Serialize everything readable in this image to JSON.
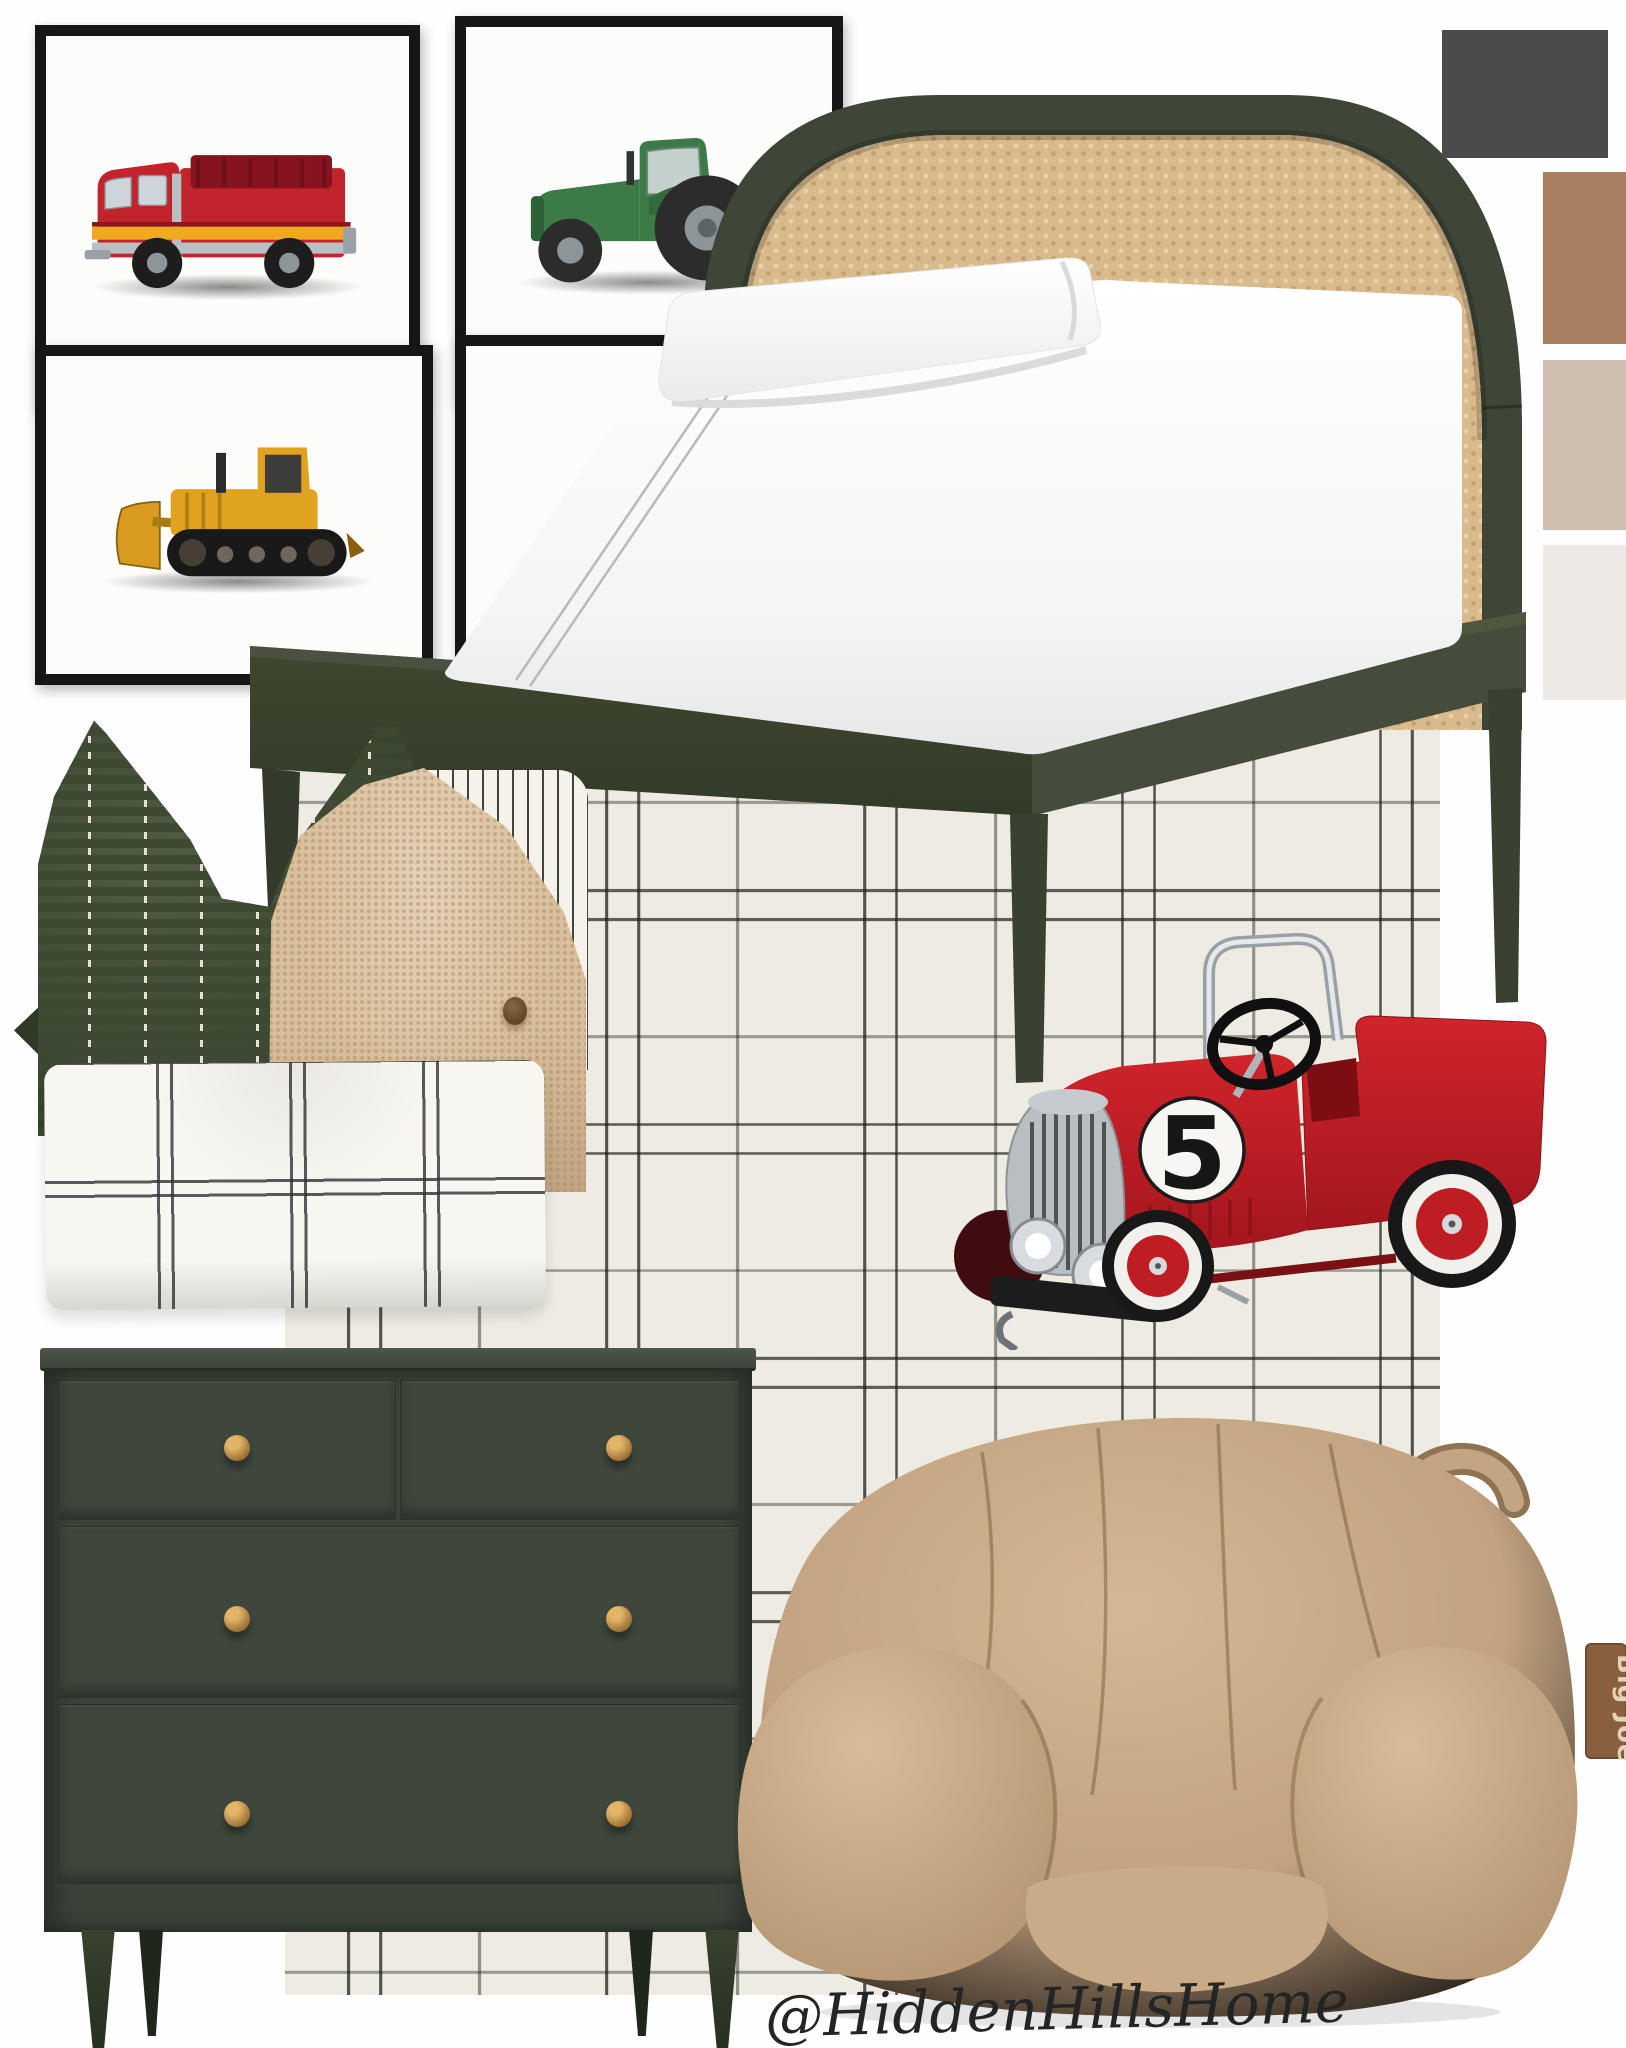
{
  "board": {
    "watermark": "@HiddenHillsHome",
    "background_hex": "#FEFEFE"
  },
  "palette": [
    {
      "name": "charcoal",
      "hex": "#4B4B4D",
      "css": "background:#4B4B4D"
    },
    {
      "name": "saddle-brown",
      "hex": "#A67F5E",
      "css": "background:#A67F5E"
    },
    {
      "name": "warm-beige",
      "hex": "#CEBFB0",
      "css": "background:#CEBFB0"
    },
    {
      "name": "off-white",
      "hex": "#EDEAE5",
      "css": "background:#EDEAE5"
    }
  ],
  "gallery": {
    "prints": [
      {
        "subject": "fire-truck-watercolor"
      },
      {
        "subject": "green-tractor-watercolor"
      },
      {
        "subject": "yellow-bulldozer-watercolor"
      },
      {
        "subject": "blank-mat"
      }
    ]
  },
  "wallpaper": {
    "pattern": "hand-drawn windowpane plaid",
    "base_hex": "#EDEBE2",
    "line_hex": "#1E1E1A"
  },
  "bed": {
    "frame_hex": "#3F4637",
    "cane_hex": "#D9BA8C",
    "headboard": "arched cane"
  },
  "pedal_car": {
    "racing_number": "5",
    "body_hex": "#BF1D24"
  },
  "dresser": {
    "body_hex": "#3B4339",
    "knob_hex": "#C89A52",
    "drawer_count": 4,
    "knob_count": 6
  },
  "bean_bag": {
    "brand_tag": "Big Joe",
    "fabric_hex": "#C4A482"
  },
  "pillows": [
    {
      "type": "green-pinstripe"
    },
    {
      "type": "black-ticking-stripe"
    },
    {
      "type": "tan-jute"
    },
    {
      "type": "white-windowpane-lumbar"
    }
  ]
}
